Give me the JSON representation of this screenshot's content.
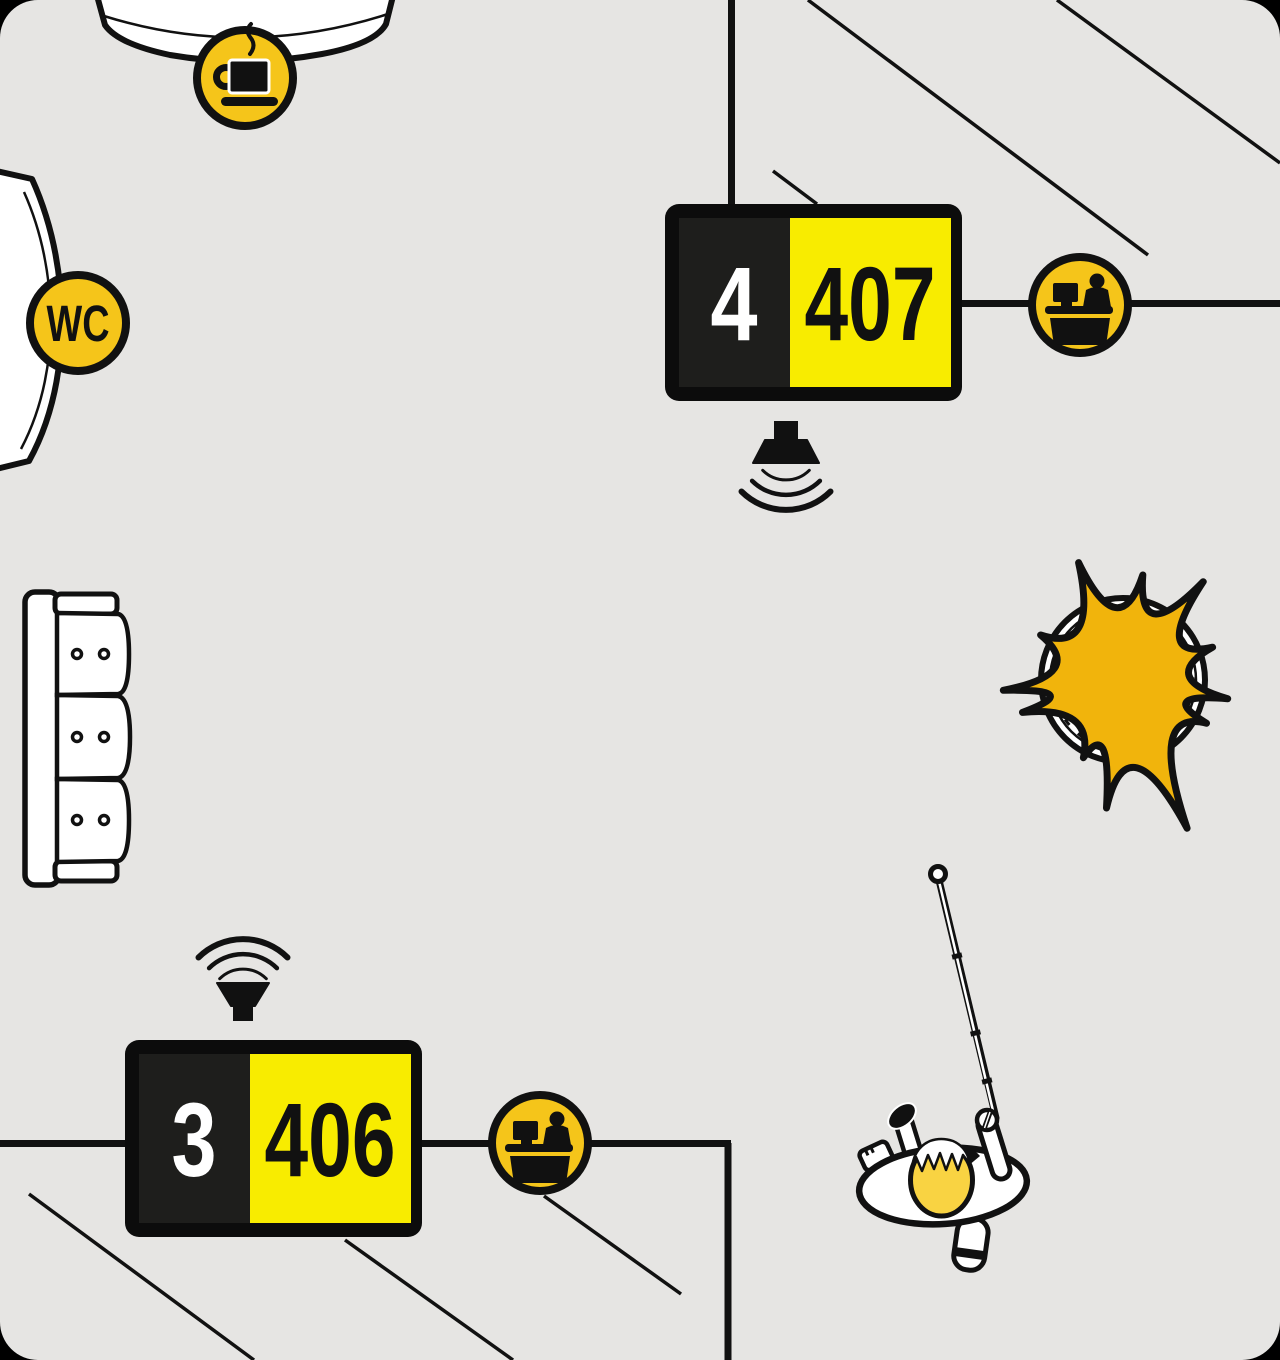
{
  "title": "waiting-area-floor-plan",
  "colors": {
    "background": "#e6e5e3",
    "outside": "#000000",
    "ink": "#111111",
    "display_frame": "#0c0c0c",
    "display_panel_dark": "#1e1e1c",
    "display_yellow": "#f8ec00",
    "badge_gold": "#f5c51a",
    "plant_gold": "#f1b40c",
    "hair_yellow": "#f9d342",
    "white": "#ffffff"
  },
  "displays": [
    {
      "queue_number": "4",
      "room_number": "407"
    },
    {
      "queue_number": "3",
      "room_number": "406"
    }
  ],
  "wc_badge": {
    "label": "WC"
  },
  "icons": {
    "coffee": "coffee-cup-icon",
    "reception": "reception-desk-icon",
    "speaker": "speaker-icon",
    "sound_waves": "sound-waves",
    "wc": "wc-text-badge"
  },
  "furniture": {
    "sofa": "three-seat-sofa-top-view",
    "plant": "potted-plant-top-view",
    "coffee_station": "coffee-station-counter",
    "wc_door": "wc-room-entrance"
  },
  "person": {
    "label": "person-with-white-cane-top-view"
  }
}
